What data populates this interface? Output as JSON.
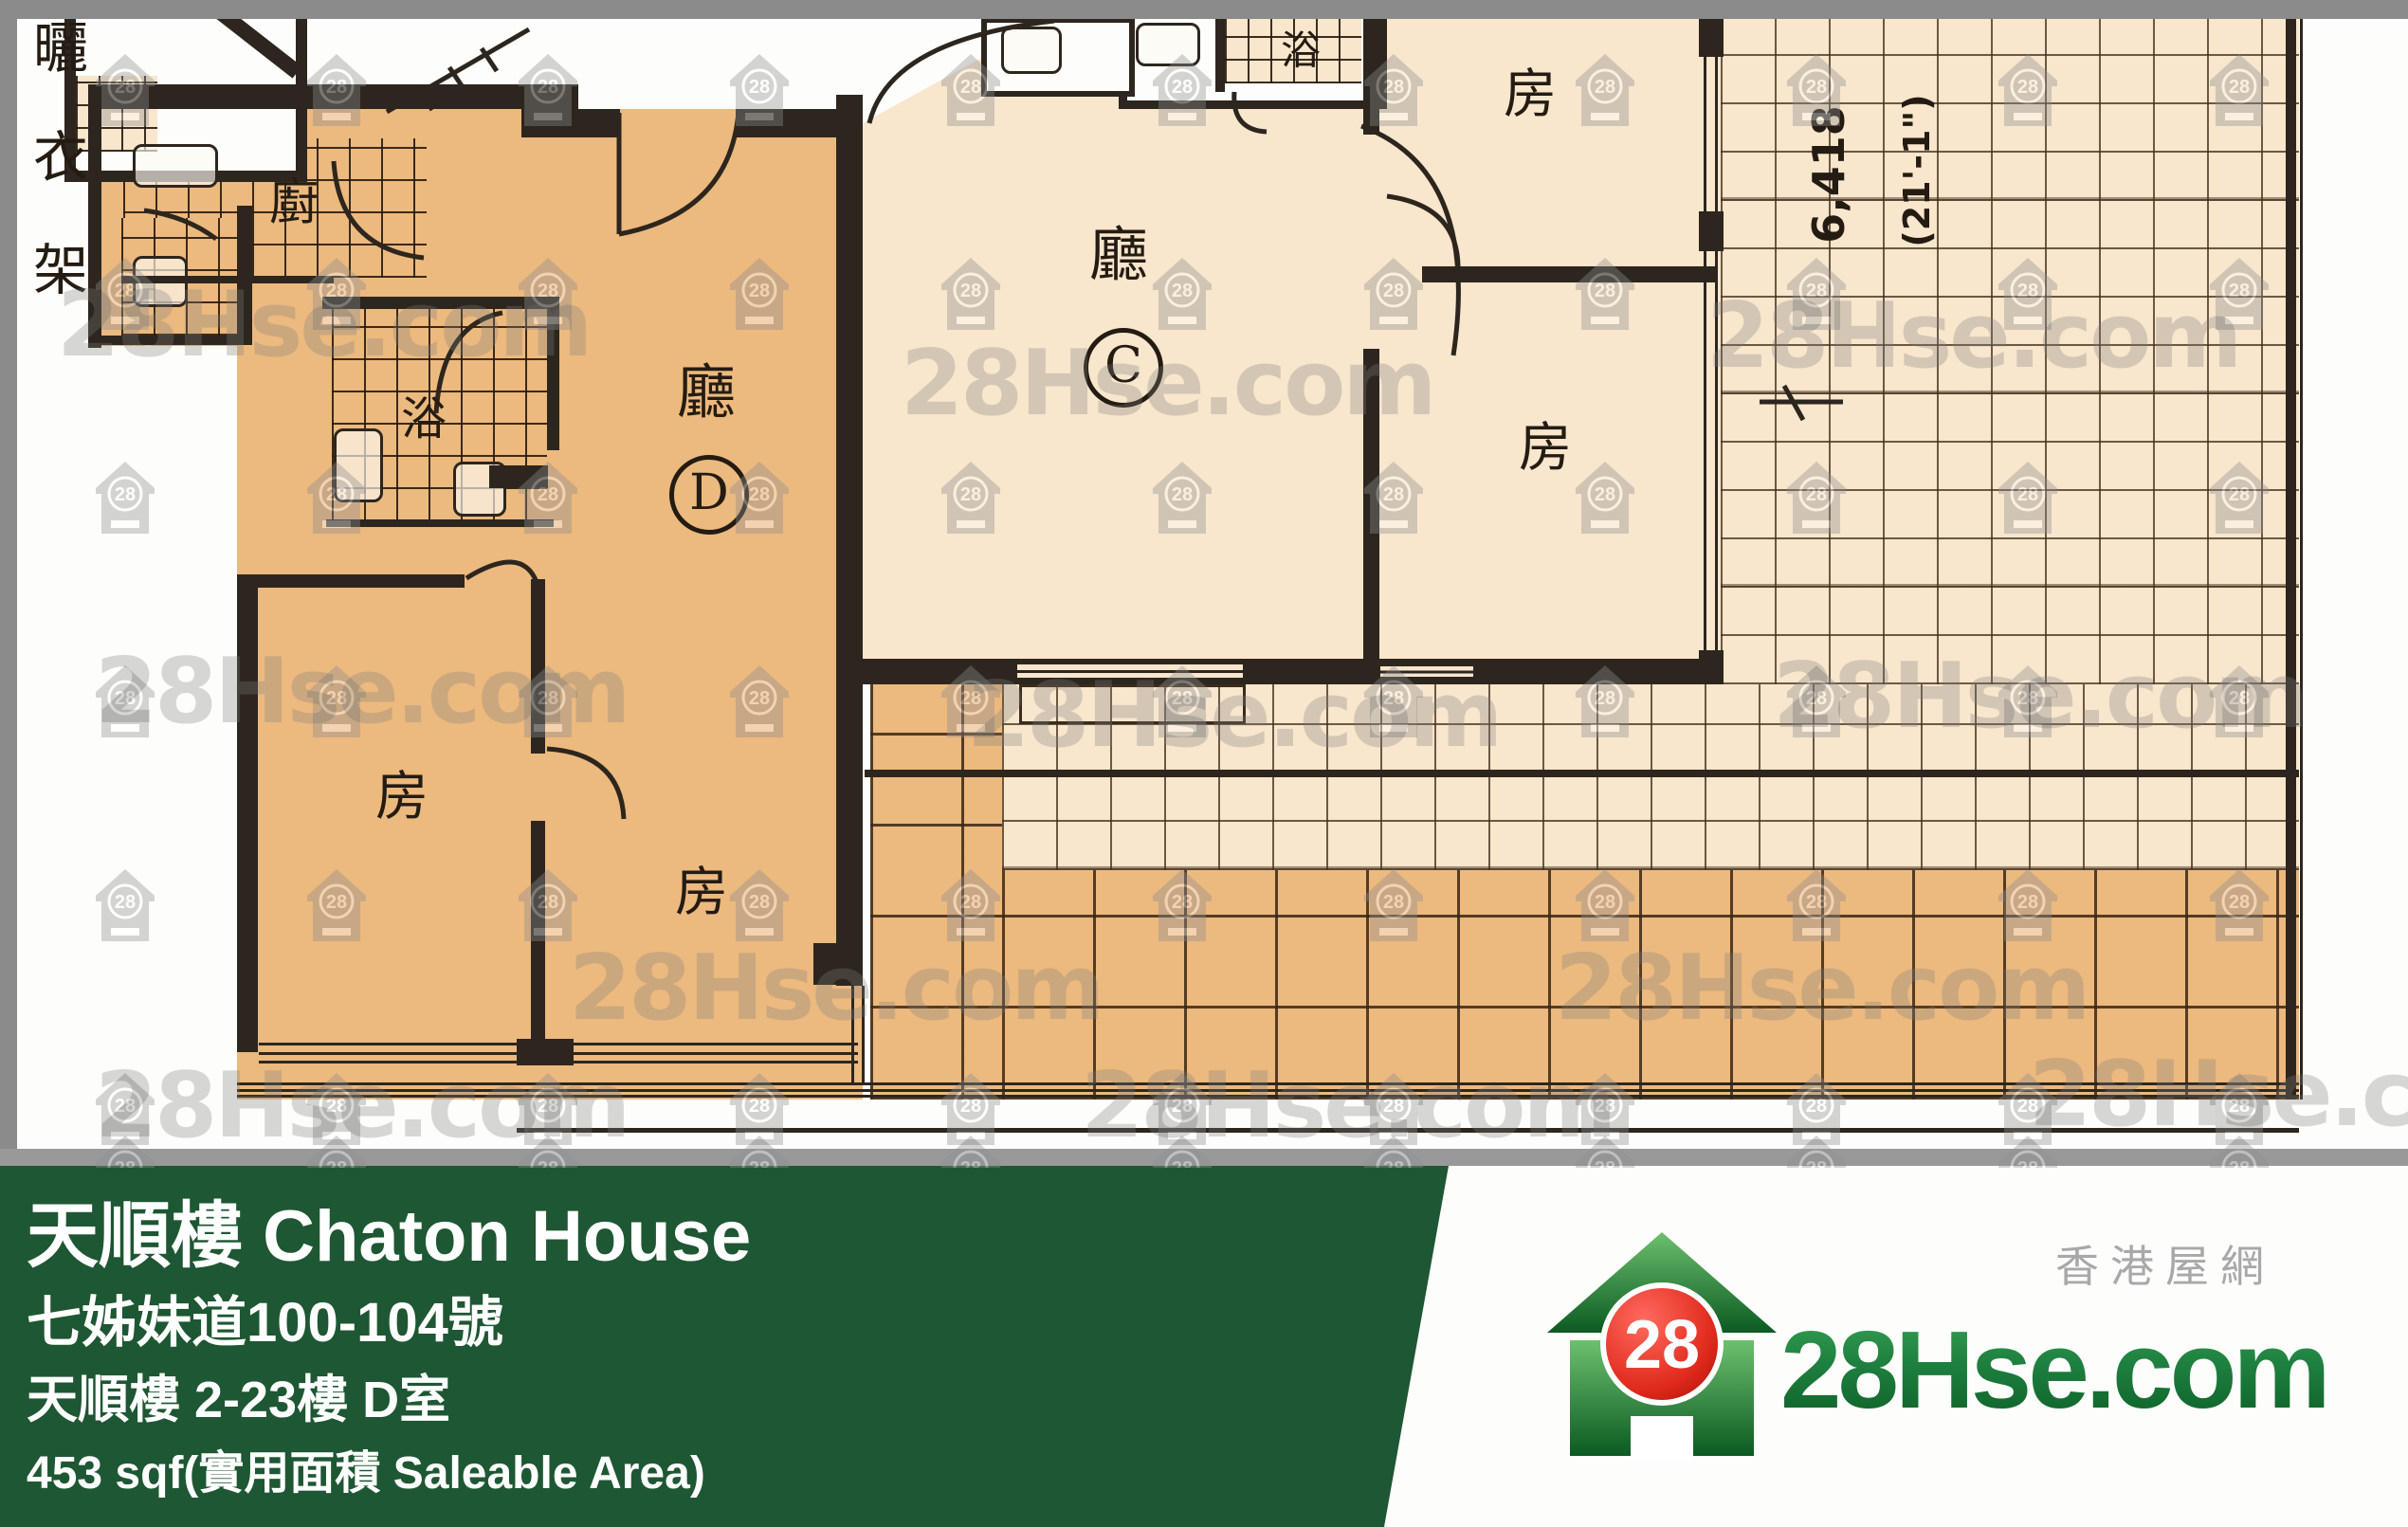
{
  "plan": {
    "labels": {
      "drying_rack_1": "曬",
      "drying_rack_2": "衣",
      "drying_rack_3": "架",
      "kitchen": "廚",
      "bath_d": "浴",
      "bath_c": "浴",
      "living_d": "廳",
      "unit_d": "D",
      "living_c": "廳",
      "unit_c": "C",
      "bed_d1": "房",
      "bed_d2": "房",
      "bed_c1": "房",
      "bed_c2": "房",
      "dim_metric": "6,418",
      "dim_imperial": "(21'-1\")"
    }
  },
  "watermark": {
    "text": "28Hse.com",
    "badge": "28"
  },
  "banner": {
    "title": "天順樓 Chaton House",
    "address": "七姊妹道100-104號",
    "block_floor_flat": "天順樓 2-23樓 D室",
    "area": "453 sqf(實用面積 Saleable Area)"
  },
  "logo": {
    "badge": "28",
    "brand_full": "28Hse.com",
    "tagline": "香港屋網"
  },
  "colors": {
    "banner_green": "#1e5733",
    "unit_d": "#ecb97e",
    "unit_c": "#f8e6cd",
    "wall": "#2d261e",
    "chrome": "#8b8b8b",
    "logo_green": "#1e8040",
    "logo_red": "#da251c"
  }
}
